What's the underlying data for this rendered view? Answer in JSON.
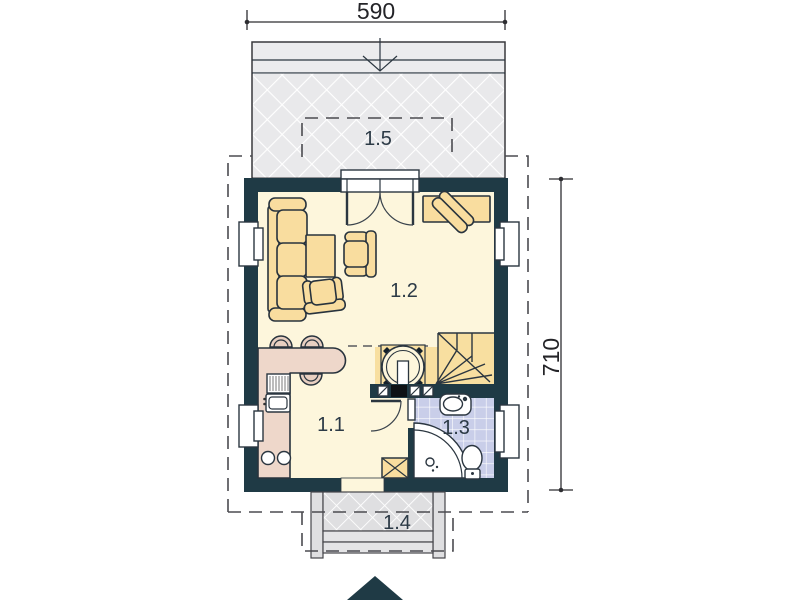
{
  "plan": {
    "type": "floor-plan",
    "dimensions": {
      "width": "590",
      "height": "710"
    },
    "rooms": [
      {
        "label": "1.1"
      },
      {
        "label": "1.2"
      },
      {
        "label": "1.3"
      },
      {
        "label": "1.4"
      },
      {
        "label": "1.5"
      }
    ],
    "colors": {
      "wall": "#1f3a45",
      "floor": "#fdf6dc",
      "hall-floor": "#f8dfa0",
      "furniture": "#f9dd9f",
      "furniture-outline": "#28333d",
      "kitchen-counter": "#eed7ca",
      "stool": "#e8cfc1",
      "bathroom-tile": "#c9cee9",
      "terrace": "#e9e9eb",
      "porch": "#dfdfe1",
      "line": "#2e2e32"
    }
  }
}
